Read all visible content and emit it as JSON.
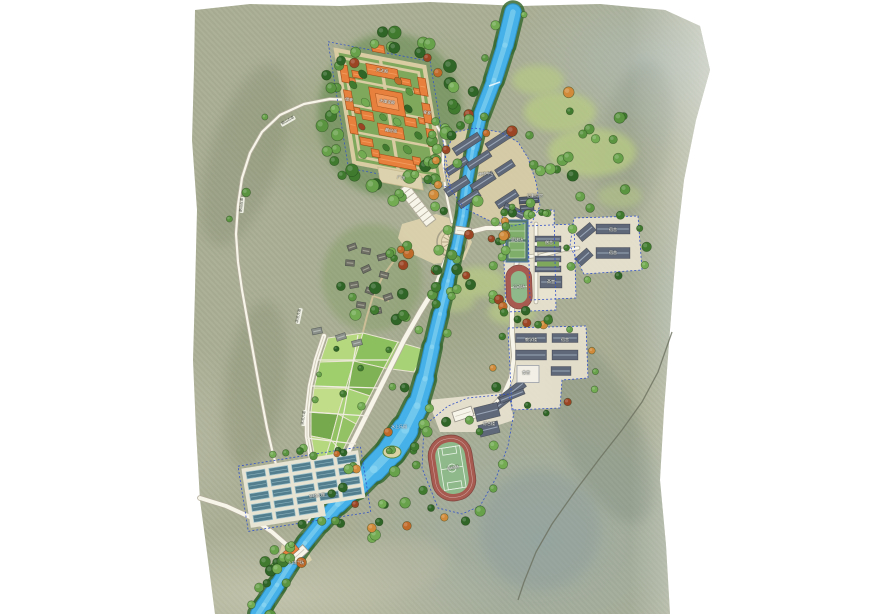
{
  "map": {
    "palette": {
      "page_bg": "#ffffff",
      "terrain_base": "#a9ae94",
      "river": "#45b1e8",
      "river_edge": "#2e8fc0",
      "river_light": "#9adef5",
      "river_bank": "#3a6b33",
      "road_fill": "#f7f4e9",
      "road_edge": "#b2ad9b",
      "trail": "#6b705f",
      "dirt": "#cbbd96",
      "temple_roof": "#e6803c",
      "temple_roof_light": "#f29a5c",
      "temple_ridge": "#9c4a18",
      "temple_wall": "#d9cba2",
      "courtyard": "#7fa85c",
      "plaza": "#ddd2ae",
      "paving": "#e8e2d0",
      "paving_warm": "#d9cda8",
      "gray_roof": "#5f6878",
      "gray_ridge": "#9aa7b8",
      "dark_roof": "#4f5866",
      "white_bldg": "#f2efe6",
      "house_roof": "#6e6e64",
      "shed": "#8a8f8a",
      "field_colors": [
        "#b5d87e",
        "#8cbf5e",
        "#9fcf6d",
        "#7fb254",
        "#c2dd8a",
        "#a8d276",
        "#76a84e",
        "#93c264"
      ],
      "greenhouse": "#527e8e",
      "greenhouse_lid": "#9fc3cc",
      "track": "#a65a50",
      "pitch": "#8fb98a",
      "court": "#7fae6a",
      "court_base": "#55796b",
      "tree_greens": [
        "#3f7a2f",
        "#5a9440",
        "#72ab52",
        "#2f6526",
        "#67a14a"
      ],
      "tree_autumn": [
        "#c06a2a",
        "#9c4524",
        "#d08a3a"
      ],
      "boundary": "#3352c8",
      "lawn": "#b7ca85"
    },
    "labels": [
      {
        "text": "天王殿",
        "x": 382,
        "y": 71,
        "rot": 9,
        "style": "building"
      },
      {
        "text": "大雄宝殿",
        "x": 387,
        "y": 102,
        "rot": 9,
        "style": "building"
      },
      {
        "text": "藏经阁",
        "x": 391,
        "y": 131,
        "rot": 9,
        "style": "building"
      },
      {
        "text": "僧寮",
        "x": 349,
        "y": 100,
        "rot": 9,
        "style": "building"
      },
      {
        "text": "客堂",
        "x": 427,
        "y": 113,
        "rot": 9,
        "style": "building"
      },
      {
        "text": "广场",
        "x": 401,
        "y": 178,
        "rot": 9,
        "style": "building"
      },
      {
        "text": "朝山古道",
        "x": 288,
        "y": 121,
        "rot": -30,
        "style": "road"
      },
      {
        "text": "朝山古道",
        "x": 242,
        "y": 205,
        "rot": -85,
        "style": "road"
      },
      {
        "text": "滨河大道",
        "x": 299,
        "y": 316,
        "rot": -78,
        "style": "road"
      },
      {
        "text": "滨河大道",
        "x": 304,
        "y": 418,
        "rot": -82,
        "style": "road"
      },
      {
        "text": "水上乐园",
        "x": 399,
        "y": 427,
        "rot": 0,
        "style": "water"
      },
      {
        "text": "种植大棚",
        "x": 317,
        "y": 496,
        "rot": -8,
        "style": "building"
      },
      {
        "text": "入口广场",
        "x": 296,
        "y": 563,
        "rot": 0,
        "style": "building"
      },
      {
        "text": "禅修中心",
        "x": 486,
        "y": 174,
        "rot": -5,
        "style": "building"
      },
      {
        "text": "后勤用房",
        "x": 535,
        "y": 196,
        "rot": 0,
        "style": "building"
      },
      {
        "text": "篮球场",
        "x": 517,
        "y": 240,
        "rot": 0,
        "style": "building"
      },
      {
        "text": "运动场",
        "x": 519,
        "y": 287,
        "rot": 0,
        "style": "building"
      },
      {
        "text": "僧舍",
        "x": 549,
        "y": 243,
        "rot": 0,
        "style": "building"
      },
      {
        "text": "斋堂",
        "x": 551,
        "y": 282,
        "rot": 0,
        "style": "building"
      },
      {
        "text": "宿舍",
        "x": 613,
        "y": 230,
        "rot": 0,
        "style": "building"
      },
      {
        "text": "宿舍",
        "x": 613,
        "y": 253,
        "rot": 0,
        "style": "building"
      },
      {
        "text": "教学楼",
        "x": 531,
        "y": 340,
        "rot": 0,
        "style": "building"
      },
      {
        "text": "宿舍",
        "x": 565,
        "y": 340,
        "rot": 0,
        "style": "building"
      },
      {
        "text": "食堂",
        "x": 526,
        "y": 373,
        "rot": 0,
        "style": "building"
      },
      {
        "text": "综合楼",
        "x": 489,
        "y": 424,
        "rot": 0,
        "style": "building"
      },
      {
        "text": "运动场",
        "x": 453,
        "y": 468,
        "rot": -9,
        "style": "building"
      }
    ]
  }
}
